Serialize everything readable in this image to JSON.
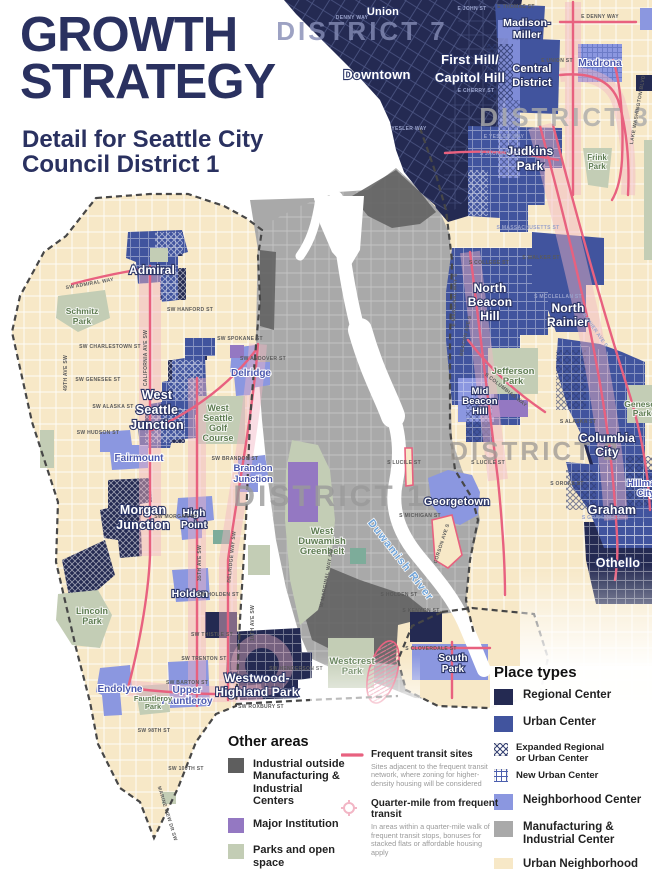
{
  "title": {
    "line1": "GROWTH",
    "line2": "STRATEGY",
    "subtitle_line1": "Detail for Seattle City",
    "subtitle_line2": "Council District 1"
  },
  "colors": {
    "title_navy": "#2a3160",
    "regional_center": "#242a52",
    "urban_center": "#41549e",
    "neighborhood_center": "#8b97e0",
    "manufacturing": "#a9a9a9",
    "urban_neighborhood": "#f7e8c7",
    "industrial_outside": "#5e5e5e",
    "major_institution": "#9478c2",
    "parks_open_space": "#c3cdb5",
    "cemetery": "#7dac9a",
    "transit_pink": "#e8617f",
    "quarter_mile_pink": "#f2b6c5"
  },
  "legend": {
    "place_types": {
      "title": "Place types",
      "regional": "Regional Center",
      "urban": "Urban Center",
      "expanded_1": "Expanded Regional",
      "expanded_2": "or Urban Center",
      "new_urban": "New Urban Center",
      "neighborhood": "Neighborhood Center",
      "manufacturing_1": "Manufacturing &",
      "manufacturing_2": "Industrial Center",
      "urban_neighborhood": "Urban Neighborhood"
    },
    "other_areas": {
      "title": "Other areas",
      "industrial_1": "Industrial outside",
      "industrial_2": "Manufacturing &",
      "industrial_3": "Industrial Centers",
      "major_institution": "Major Institution",
      "parks": "Parks and open space",
      "cemetery": "Cemetery"
    },
    "transit": {
      "frequent_title": "Frequent transit sites",
      "frequent_desc": "Sites adjacent to the frequent transit network, where zoning for higher-density housing will be considered",
      "quarter_title": "Quarter-mile from frequent transit",
      "quarter_desc": "In areas within a quarter-mile walk of frequent transit stops, bonuses for stacked flats or affordable housing apply"
    }
  },
  "map": {
    "districts": {
      "d7": "DISTRICT 7",
      "d3": "DISTRICT 3",
      "d2": "DISTRICT 2",
      "d1": "DISTRICT 1"
    },
    "areas": {
      "union": "Union",
      "downtown": "Downtown",
      "first_hill_1": "First Hill/",
      "first_hill_2": "Capitol Hill",
      "madison_miller_1": "Madison-",
      "madison_miller_2": "Miller",
      "central_district_1": "Central",
      "central_district_2": "District",
      "madrona": "Madrona",
      "judkins_1": "Judkins",
      "judkins_2": "Park",
      "north_beacon_1": "North",
      "north_beacon_2": "Beacon",
      "north_beacon_3": "Hill",
      "north_rainier_1": "North",
      "north_rainier_2": "Rainier",
      "mid_beacon_1": "Mid",
      "mid_beacon_2": "Beacon",
      "mid_beacon_3": "Hill",
      "columbia_1": "Columbia",
      "columbia_2": "City",
      "hillman_1": "Hillman",
      "hillman_2": "City",
      "graham": "Graham",
      "othello": "Othello",
      "georgetown": "Georgetown",
      "south_park_1": "South",
      "south_park_2": "Park",
      "admiral": "Admiral",
      "ws_junction_1": "West",
      "ws_junction_2": "Seattle",
      "ws_junction_3": "Junction",
      "morgan_1": "Morgan",
      "morgan_2": "Junction",
      "fairmount": "Fairmount",
      "delridge": "Delridge",
      "brandon_1": "Brandon",
      "brandon_2": "Junction",
      "high_point_1": "High",
      "high_point_2": "Point",
      "holden": "Holden",
      "endolyne": "Endolyne",
      "upper_fauntleroy_1": "Upper",
      "upper_fauntleroy_2": "Fauntleroy",
      "westwood_1": "Westwood-",
      "westwood_2": "Highland Park"
    },
    "parks": {
      "schmitz_1": "Schmitz",
      "schmitz_2": "Park",
      "golf_1": "West",
      "golf_2": "Seattle",
      "golf_3": "Golf",
      "golf_4": "Course",
      "lincoln_1": "Lincoln",
      "lincoln_2": "Park",
      "fauntleroy_1": "Fauntleroy",
      "fauntleroy_2": "Park",
      "westcrest_1": "Westcrest",
      "westcrest_2": "Park",
      "greenbelt_1": "West",
      "greenbelt_2": "Duwamish",
      "greenbelt_3": "Greenbelt",
      "jefferson_1": "Jefferson",
      "jefferson_2": "Park",
      "frink_1": "Frink",
      "frink_2": "Park",
      "genesee_1": "Genesee",
      "genesee_2": "Park"
    },
    "water": {
      "duwamish": "Duwamish River"
    },
    "streets": {
      "denny": "DENNY WAY",
      "e_john": "E JOHN ST",
      "e_thomas": "E THOMAS ST",
      "e_denny": "E DENNY WAY",
      "e_union": "E UNION ST",
      "e_cherry": "E CHERRY ST",
      "yesler": "YESLER WAY",
      "e_yesler": "E YESLER WAY",
      "s_jackson": "S JACKSON ST",
      "lake_wash": "LAKE WASHINGTON BLVD",
      "s_mass": "S MASSACHUSETTS ST",
      "s_college": "S COLLEGE ST",
      "s_walker": "S WALKER ST",
      "s_mcclellan": "S MCCLELLAN ST",
      "beacon": "BEACON AVE S",
      "columbian": "S COLUMBIAN WAY",
      "rainier": "RAINIER AVE S",
      "s_alaska": "S ALASKA ST",
      "s_orcas": "S ORCAS ST",
      "s_graham": "S GRAHAM ST",
      "s_lucile": "S LUCILE ST",
      "s_michigan": "S MICHIGAN ST",
      "s_holden": "S HOLDEN ST",
      "s_kenyon": "S KENYON ST",
      "s_cloverdale": "S CLOVERDALE ST",
      "corson": "CORSON AVE S",
      "e_marginal": "E MARGINAL WAY S",
      "w_marginal": "W MARGINAL WAY SW",
      "sw_spokane": "SW SPOKANE ST",
      "sw_andover": "SW ANDOVER ST",
      "sw_admiral": "SW ADMIRAL WAY",
      "sw_hanford": "SW HANFORD ST",
      "sw_charlestown": "SW CHARLESTOWN ST",
      "sw_genesee": "SW GENESEE ST",
      "sw_alaska": "SW ALASKA ST",
      "sw_hudson": "SW HUDSON ST",
      "sw_brandon": "SW BRANDON ST",
      "california": "CALIFORNIA AVE SW",
      "ave49": "49TH AVE SW",
      "ave35": "35TH AVE SW",
      "ave16": "16TH AVE SW",
      "delridge_way": "DELRIDGE WAY SW",
      "sw_morgan": "SW MORGAN ST",
      "sw_holden": "SW HOLDEN ST",
      "sw_thistle": "SW THISTLE ST",
      "sw_trenton": "SW TRENTON ST",
      "sw_henderson": "SW HENDERSON ST",
      "sw_barton": "SW BARTON ST",
      "sw_roxbury": "SW ROXBURY ST",
      "sw_98": "SW 98TH ST",
      "sw_100": "SW 100TH ST",
      "marine_view": "MARINE VIEW DR SW"
    }
  }
}
